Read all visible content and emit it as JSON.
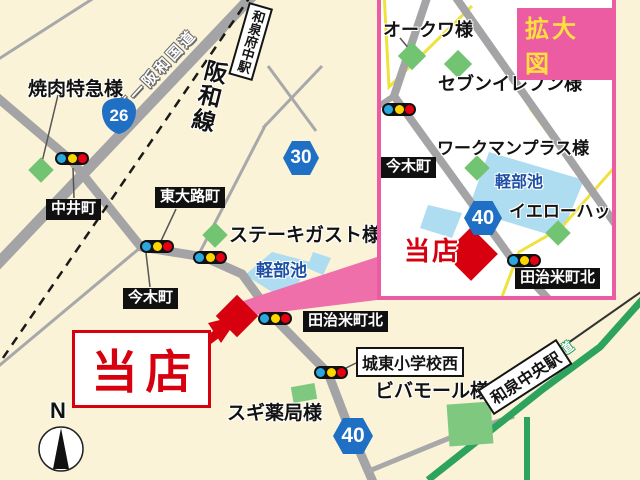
{
  "main": {
    "yakiniku": "焼肉特急様",
    "route26": "26",
    "dai1_hanwa": "第一阪和国道",
    "izumifuchu_sta": "和泉府中駅",
    "hanwa_line": "阪和線",
    "nakaicho": "中井町",
    "higashiojicho": "東大路町",
    "route30": "30",
    "steak_gusto": "ステーキガスト様",
    "karubeike": "軽部池",
    "imakicho": "今木町",
    "tajimecho_kita": "田治米町北",
    "store": "当店",
    "joto_shogakko_nishi": "城東小学校西",
    "vivamall": "ビバモール様",
    "sugi_pharmacy": "スギ薬局様",
    "route40": "40",
    "izumichuo_sta": "和泉中央駅",
    "hanwa_expwy": "阪和自動車道",
    "compass": "N"
  },
  "inset": {
    "title": "拡大図",
    "okuwa": "オークワ様",
    "seven_eleven": "セブンイレブン様",
    "workman_plus": "ワークマンプラス様",
    "karubeike": "軽部池",
    "yellow_hat": "イエローハット様",
    "imakicho": "今木町",
    "route40": "40",
    "store": "当店",
    "tajimecho_kita": "田治米町北"
  },
  "colors": {
    "background": "#FAF3D7",
    "road_gray": "#A4A4A6",
    "railway_black": "#1A1A1A",
    "pond_blue": "#AEDCF0",
    "pond_text_blue": "#1D50A5",
    "green_marker": "#72C472",
    "expressway_green": "#2EA35E",
    "yellow_road": "#EFE23E",
    "accent_pink": "#EB5CA3",
    "store_red": "#D7000F",
    "badge_blue": "#1F6FC5",
    "signal_blue": "#29A8E0",
    "signal_yellow": "#FFD500",
    "signal_red": "#E60012",
    "title_yellow": "#FFE03C"
  }
}
